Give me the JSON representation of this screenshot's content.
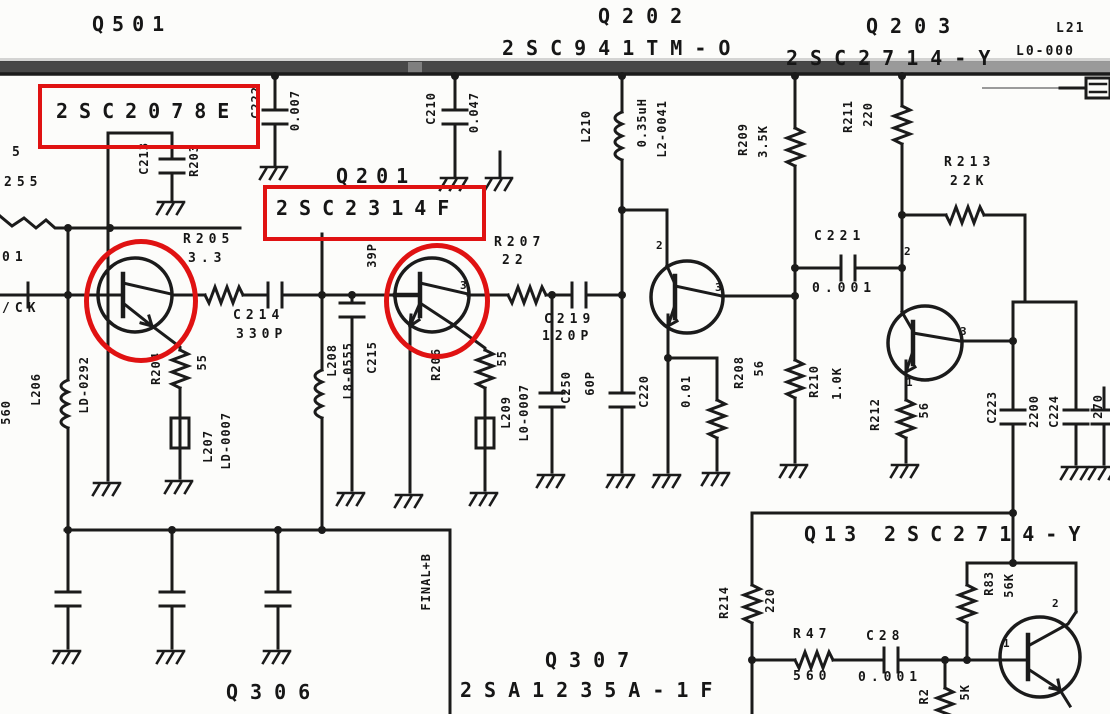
{
  "ink_color": "#161616",
  "annotation_color": "#e01212",
  "highlighted_parts": [
    "2SC2078E",
    "2SC2314F"
  ],
  "labels": [
    {
      "t": "Q501",
      "x": 92,
      "y": 14,
      "c": "xl",
      "ls": 8,
      "n": "label-q501"
    },
    {
      "t": "Q202",
      "x": 598,
      "y": 6,
      "c": "xl",
      "ls": 12,
      "n": "label-q202"
    },
    {
      "t": "2SC941TM-O",
      "x": 502,
      "y": 38,
      "c": "xl",
      "ls": 12,
      "n": "label-q202-part"
    },
    {
      "t": "Q203",
      "x": 866,
      "y": 16,
      "c": "xl",
      "ls": 12,
      "n": "label-q203"
    },
    {
      "t": "2SC2714-Y",
      "x": 786,
      "y": 48,
      "c": "xl",
      "ls": 12,
      "n": "label-q203-part"
    },
    {
      "t": "L21",
      "x": 1056,
      "y": 22,
      "c": "md",
      "n": "label-l21"
    },
    {
      "t": "L0-000",
      "x": 1016,
      "y": 45,
      "c": "md",
      "n": "label-l0-000"
    },
    {
      "t": "Q201",
      "x": 336,
      "y": 166,
      "c": "xl",
      "ls": 8,
      "n": "label-q201"
    },
    {
      "t": "2SC2078E",
      "x": 56,
      "y": 101,
      "c": "xl",
      "ls": 11,
      "n": "label-2sc2078e"
    },
    {
      "t": "2SC2314F",
      "x": 276,
      "y": 198,
      "c": "xl",
      "ls": 11,
      "n": "label-2sc2314f"
    },
    {
      "t": "Q13",
      "x": 804,
      "y": 524,
      "c": "xl",
      "ls": 8,
      "n": "label-q13"
    },
    {
      "t": "2SC2714-Y",
      "x": 884,
      "y": 524,
      "c": "xl",
      "ls": 11,
      "n": "label-q13-part"
    },
    {
      "t": "Q306",
      "x": 226,
      "y": 682,
      "c": "xl",
      "ls": 12,
      "n": "label-q306"
    },
    {
      "t": "Q307",
      "x": 545,
      "y": 650,
      "c": "xl",
      "ls": 12,
      "n": "label-q307"
    },
    {
      "t": "2SA1235A-1F",
      "x": 460,
      "y": 680,
      "c": "xl",
      "ls": 12,
      "n": "label-q307-part"
    },
    {
      "t": "R205",
      "x": 183,
      "y": 233,
      "c": "sm",
      "n": "label-r205"
    },
    {
      "t": "3.3",
      "x": 188,
      "y": 252,
      "c": "sm",
      "n": "label-r205-value"
    },
    {
      "t": "C214",
      "x": 233,
      "y": 309,
      "c": "sm",
      "n": "label-c214"
    },
    {
      "t": "330P",
      "x": 236,
      "y": 328,
      "c": "sm",
      "n": "label-c214-value"
    },
    {
      "t": "R207",
      "x": 494,
      "y": 236,
      "c": "sm",
      "n": "label-r207"
    },
    {
      "t": "22",
      "x": 502,
      "y": 254,
      "c": "sm",
      "n": "label-r207-value"
    },
    {
      "t": "C219",
      "x": 544,
      "y": 313,
      "c": "sm",
      "n": "label-c219"
    },
    {
      "t": "120P",
      "x": 542,
      "y": 330,
      "c": "sm",
      "n": "label-c219-value"
    },
    {
      "t": "R213",
      "x": 944,
      "y": 156,
      "c": "sm",
      "n": "label-r213"
    },
    {
      "t": "22K",
      "x": 950,
      "y": 175,
      "c": "sm",
      "n": "label-r213-value"
    },
    {
      "t": "C221",
      "x": 814,
      "y": 230,
      "c": "sm",
      "n": "label-c221"
    },
    {
      "t": "0.001",
      "x": 812,
      "y": 282,
      "c": "sm",
      "n": "label-c221-value"
    },
    {
      "t": "R47",
      "x": 793,
      "y": 628,
      "c": "sm",
      "n": "label-r47"
    },
    {
      "t": "560",
      "x": 793,
      "y": 670,
      "c": "sm",
      "n": "label-r47-value"
    },
    {
      "t": "C28",
      "x": 866,
      "y": 630,
      "c": "sm",
      "n": "label-c28"
    },
    {
      "t": "0.001",
      "x": 858,
      "y": 671,
      "c": "sm",
      "n": "label-c28-value"
    },
    {
      "t": "/CK",
      "x": 2,
      "y": 302,
      "c": "sm",
      "n": "label-ck"
    },
    {
      "t": "5",
      "x": 12,
      "y": 146,
      "c": "sm",
      "n": "label-edge-5"
    },
    {
      "t": "255",
      "x": 4,
      "y": 176,
      "c": "sm",
      "n": "label-edge-255"
    },
    {
      "t": "01",
      "x": 2,
      "y": 251,
      "c": "sm",
      "n": "label-edge-01"
    },
    {
      "t": "C222",
      "x": 250,
      "y": 86,
      "c": "v",
      "n": "label-c222"
    },
    {
      "t": "0.007",
      "x": 289,
      "y": 90,
      "c": "v",
      "n": "label-c222-value"
    },
    {
      "t": "C210",
      "x": 425,
      "y": 92,
      "c": "v",
      "n": "label-c210"
    },
    {
      "t": "0.047",
      "x": 468,
      "y": 92,
      "c": "v",
      "n": "label-c210-value"
    },
    {
      "t": "C213",
      "x": 138,
      "y": 142,
      "c": "v",
      "n": "label-c213"
    },
    {
      "t": "R203",
      "x": 188,
      "y": 144,
      "c": "v",
      "n": "label-r203"
    },
    {
      "t": "L206",
      "x": 30,
      "y": 373,
      "c": "v",
      "n": "label-l206"
    },
    {
      "t": "LD-0292",
      "x": 78,
      "y": 356,
      "c": "v",
      "n": "label-l206-part"
    },
    {
      "t": "560",
      "x": 0,
      "y": 400,
      "c": "v",
      "n": "label-edge-560"
    },
    {
      "t": "L208",
      "x": 326,
      "y": 344,
      "c": "v",
      "n": "label-l208"
    },
    {
      "t": "L8-0555",
      "x": 342,
      "y": 342,
      "c": "v",
      "n": "label-l208-part"
    },
    {
      "t": "C215",
      "x": 366,
      "y": 341,
      "c": "v",
      "n": "label-c215"
    },
    {
      "t": "39P",
      "x": 366,
      "y": 243,
      "c": "v",
      "n": "label-c215-value"
    },
    {
      "t": "R204",
      "x": 150,
      "y": 352,
      "c": "v",
      "n": "label-r204"
    },
    {
      "t": "55",
      "x": 196,
      "y": 354,
      "c": "v",
      "n": "label-r204-value"
    },
    {
      "t": "L207",
      "x": 202,
      "y": 430,
      "c": "v",
      "n": "label-l207"
    },
    {
      "t": "LD-0007",
      "x": 220,
      "y": 412,
      "c": "v",
      "n": "label-l207-part"
    },
    {
      "t": "R206",
      "x": 430,
      "y": 348,
      "c": "v",
      "n": "label-r206"
    },
    {
      "t": "55",
      "x": 496,
      "y": 350,
      "c": "v",
      "n": "label-r206-value"
    },
    {
      "t": "L209",
      "x": 500,
      "y": 396,
      "c": "v",
      "n": "label-l209"
    },
    {
      "t": "L0-0007",
      "x": 518,
      "y": 384,
      "c": "v",
      "n": "label-l209-part"
    },
    {
      "t": "L210",
      "x": 580,
      "y": 110,
      "c": "v",
      "n": "label-l210"
    },
    {
      "t": "0.35uH",
      "x": 636,
      "y": 98,
      "c": "v",
      "n": "label-l210-value"
    },
    {
      "t": "L2-0041",
      "x": 656,
      "y": 100,
      "c": "v",
      "n": "label-l210-part"
    },
    {
      "t": "C250",
      "x": 560,
      "y": 371,
      "c": "v",
      "n": "label-c250"
    },
    {
      "t": "60P",
      "x": 584,
      "y": 371,
      "c": "v",
      "n": "label-c250-value"
    },
    {
      "t": "C220",
      "x": 638,
      "y": 375,
      "c": "v",
      "n": "label-c220"
    },
    {
      "t": "0.01",
      "x": 680,
      "y": 375,
      "c": "v",
      "n": "label-c220-value"
    },
    {
      "t": "R208",
      "x": 733,
      "y": 356,
      "c": "v",
      "n": "label-r208"
    },
    {
      "t": "56",
      "x": 753,
      "y": 360,
      "c": "v",
      "n": "label-r208-value"
    },
    {
      "t": "R209",
      "x": 737,
      "y": 123,
      "c": "v",
      "n": "label-r209"
    },
    {
      "t": "3.5K",
      "x": 757,
      "y": 125,
      "c": "v",
      "n": "label-r209-value"
    },
    {
      "t": "R211",
      "x": 842,
      "y": 100,
      "c": "v",
      "n": "label-r211"
    },
    {
      "t": "220",
      "x": 862,
      "y": 102,
      "c": "v",
      "n": "label-r211-value"
    },
    {
      "t": "R210",
      "x": 808,
      "y": 365,
      "c": "v",
      "n": "label-r210"
    },
    {
      "t": "1.0K",
      "x": 831,
      "y": 367,
      "c": "v",
      "n": "label-r210-value"
    },
    {
      "t": "R212",
      "x": 869,
      "y": 398,
      "c": "v",
      "n": "label-r212"
    },
    {
      "t": "56",
      "x": 918,
      "y": 402,
      "c": "v",
      "n": "label-r212-value"
    },
    {
      "t": "C223",
      "x": 986,
      "y": 391,
      "c": "v",
      "n": "label-c223"
    },
    {
      "t": "2200",
      "x": 1028,
      "y": 395,
      "c": "v",
      "n": "label-c224-value"
    },
    {
      "t": "C224",
      "x": 1048,
      "y": 395,
      "c": "v",
      "n": "label-c224"
    },
    {
      "t": "270",
      "x": 1092,
      "y": 394,
      "c": "v",
      "n": "label-edge-270"
    },
    {
      "t": "FINAL+B",
      "x": 420,
      "y": 553,
      "c": "v",
      "n": "label-final-b"
    },
    {
      "t": "R214",
      "x": 718,
      "y": 586,
      "c": "v",
      "n": "label-r214"
    },
    {
      "t": "220",
      "x": 764,
      "y": 588,
      "c": "v",
      "n": "label-r214-value"
    },
    {
      "t": "R83",
      "x": 983,
      "y": 571,
      "c": "v",
      "n": "label-r83"
    },
    {
      "t": "56K",
      "x": 1003,
      "y": 573,
      "c": "v",
      "n": "label-r83-value"
    },
    {
      "t": "R2",
      "x": 918,
      "y": 688,
      "c": "v",
      "n": "label-r2-cut"
    },
    {
      "t": "5K",
      "x": 959,
      "y": 684,
      "c": "v",
      "n": "label-5k"
    },
    {
      "t": "3",
      "x": 460,
      "y": 280,
      "c": "xs",
      "n": "pin-digit"
    },
    {
      "t": "2",
      "x": 656,
      "y": 240,
      "c": "xs",
      "n": "pin-digit"
    },
    {
      "t": "3",
      "x": 715,
      "y": 282,
      "c": "xs",
      "n": "pin-digit"
    },
    {
      "t": "2",
      "x": 904,
      "y": 246,
      "c": "xs",
      "n": "pin-digit"
    },
    {
      "t": "3",
      "x": 960,
      "y": 326,
      "c": "xs",
      "n": "pin-digit"
    },
    {
      "t": "1",
      "x": 906,
      "y": 377,
      "c": "xs",
      "n": "pin-digit"
    },
    {
      "t": "2",
      "x": 1052,
      "y": 598,
      "c": "xs",
      "n": "pin-digit"
    },
    {
      "t": "1",
      "x": 1003,
      "y": 638,
      "c": "xs",
      "n": "pin-digit"
    }
  ],
  "annotations": [
    {
      "kind": "rect",
      "x": 38,
      "y": 84,
      "w": 214,
      "h": 57,
      "n": "highlight-box-2sc2078e"
    },
    {
      "kind": "rect",
      "x": 263,
      "y": 185,
      "w": 215,
      "h": 48,
      "n": "highlight-box-2sc2314f"
    },
    {
      "kind": "ellipse",
      "x": 84,
      "y": 239,
      "w": 104,
      "h": 114,
      "n": "highlight-circle-q501-transistor"
    },
    {
      "kind": "ellipse",
      "x": 384,
      "y": 243,
      "w": 96,
      "h": 106,
      "n": "highlight-circle-q201-transistor"
    }
  ]
}
